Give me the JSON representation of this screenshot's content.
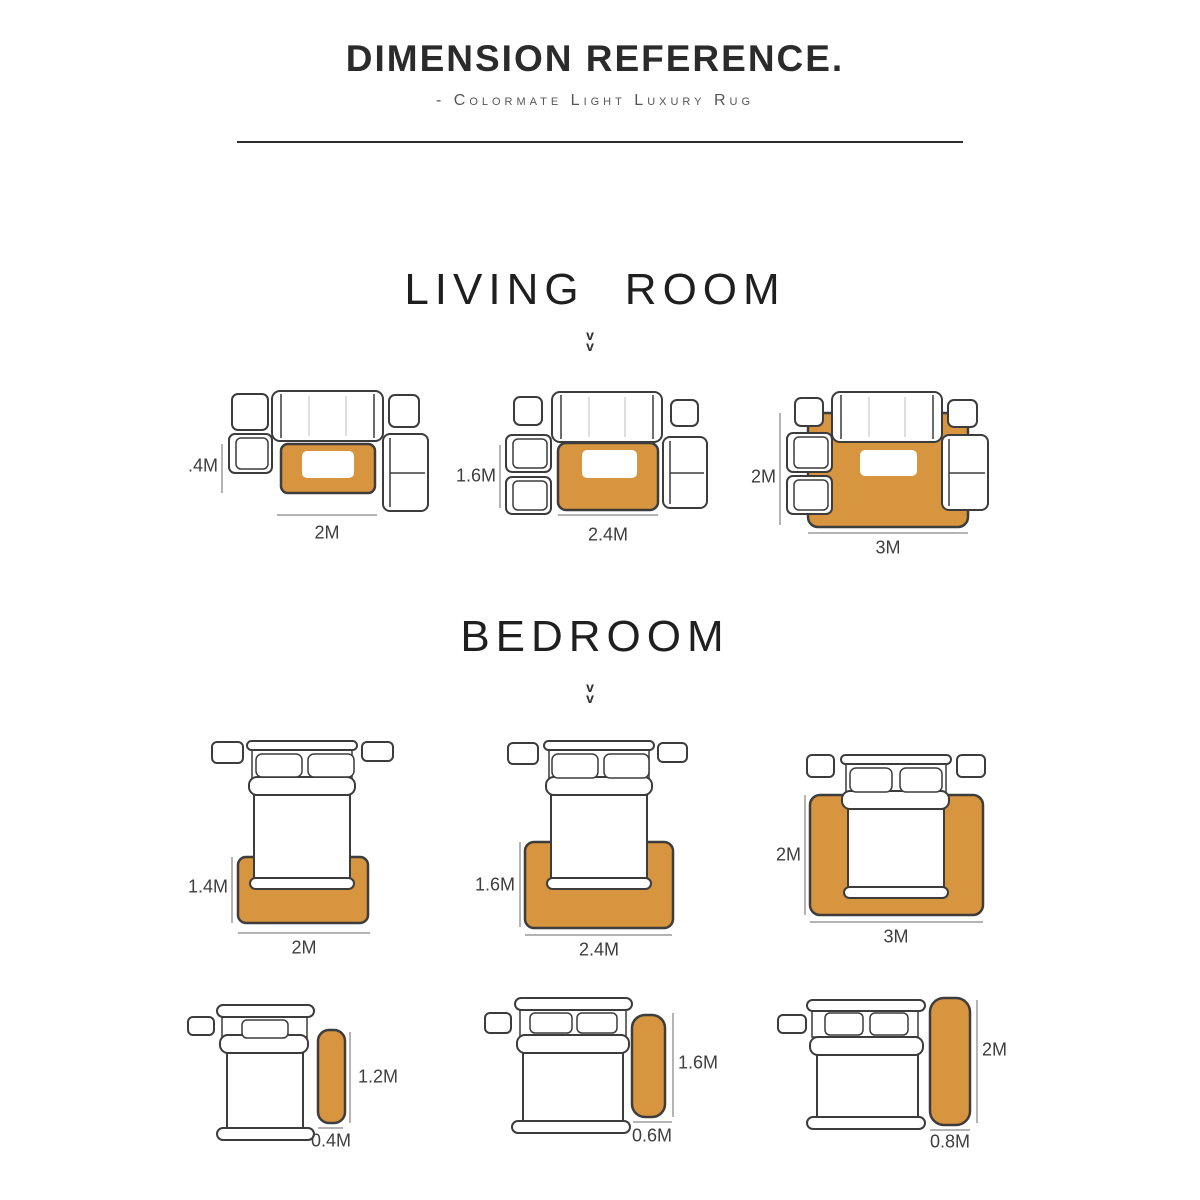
{
  "header": {
    "title": "DIMENSION REFERENCE.",
    "subtitle": "- Colormate Light Luxury Rug"
  },
  "colors": {
    "rug_orange": "#d8953f",
    "outline": "#3c3c3c",
    "dimension_line": "#9a9a9a",
    "heading_text": "#1f1f1f"
  },
  "sections": {
    "living_room": {
      "heading": "LIVING ROOM",
      "chevron": "v\nv",
      "layouts": [
        {
          "height_label": ".4M",
          "width_label": "2M"
        },
        {
          "height_label": "1.6M",
          "width_label": "2.4M"
        },
        {
          "height_label": "2M",
          "width_label": "3M"
        }
      ]
    },
    "bedroom": {
      "heading": "BEDROOM",
      "chevron": "v\nv",
      "layouts": [
        {
          "height_label": "1.4M",
          "width_label": "2M"
        },
        {
          "height_label": "1.6M",
          "width_label": "2.4M"
        },
        {
          "height_label": "2M",
          "width_label": "3M"
        }
      ],
      "runner_layouts": [
        {
          "height_label": "1.2M",
          "width_label": "0.4M"
        },
        {
          "height_label": "1.6M",
          "width_label": "0.6M"
        },
        {
          "height_label": "2M",
          "width_label": "0.8M"
        }
      ]
    }
  }
}
